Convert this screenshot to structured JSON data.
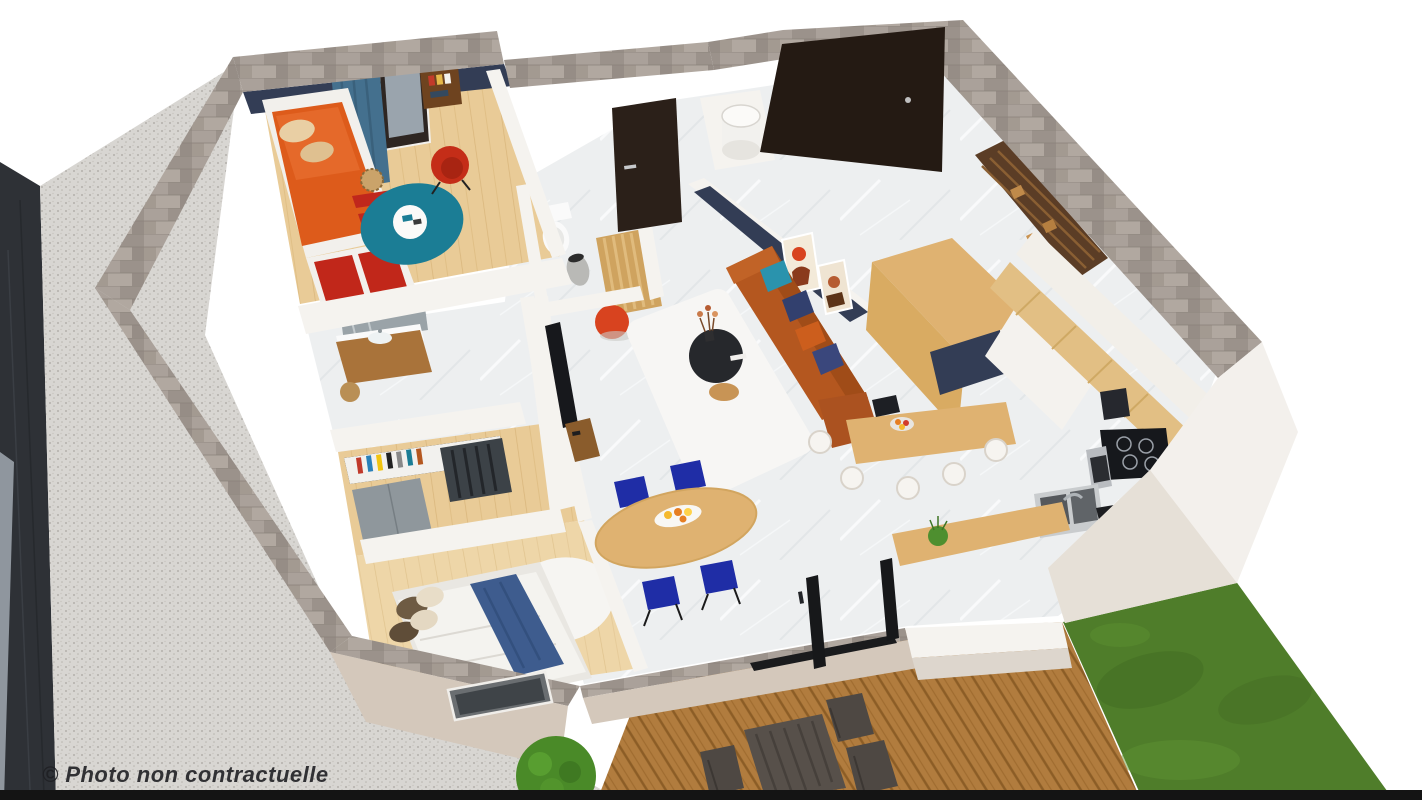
{
  "watermark": {
    "text": "© Photo non contractuelle"
  },
  "palette": {
    "stone": "#a39a91",
    "wall-white": "#f5f3ef",
    "stucco": "#d4c8bb",
    "navy": "#333d55",
    "sofa": "#b4571f",
    "teal": "#1b7d95",
    "chair-blue": "#1f2da6",
    "orange": "#d8431f",
    "door-dark": "#241a13",
    "dark-building": "#2e3136",
    "wood-warm": "#dfb271",
    "grass": "#4f7d2a",
    "marble": "#edeff0",
    "wood-floor": "#e9cb97",
    "deck-wood": "#b17c3e",
    "gravel": "#d8d6d2",
    "mattress-orange": "#dd5b1b",
    "watermark": "#1f2024"
  }
}
